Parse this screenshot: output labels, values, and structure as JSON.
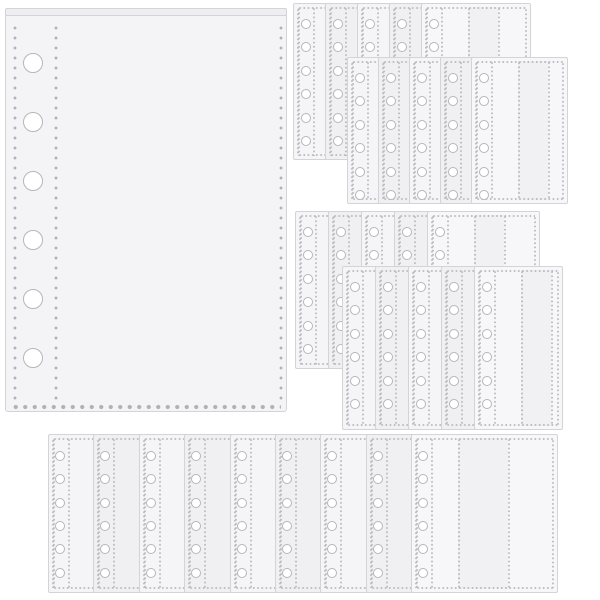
{
  "scene": {
    "width": 600,
    "height": 600,
    "background": "#ffffff",
    "subject": "transparent-6-ring-binder-sleeve-refill-pages",
    "colors": {
      "page_border": "#d4d4d8",
      "page_fill": "#f5f5f7",
      "page_fill_alt": "#f0f0f3",
      "top_page_fill": "#f7f7f9",
      "large_page_fill": "#f4f4f6",
      "flap_fill": "#eeeef1",
      "stitch_dot": "#bcbcc0",
      "stitch_dot_big": "#b2b2b6",
      "hole_ring": "#b6b6ba",
      "hole_fill": "#ffffff",
      "column_tint": "rgba(128,128,140,0.05)"
    },
    "large_page": {
      "x": 5,
      "y": 8,
      "width": 282,
      "height": 404,
      "flap_height": 8,
      "hole_count": 6,
      "hole_radius": 10,
      "hole_cx": 27,
      "hole_first_y": 54,
      "hole_spacing": 59,
      "dot_columns_x": [
        7,
        48,
        273
      ],
      "dots_top_y": 14,
      "bottom_dots_y": 395
    },
    "stack_page_spec": {
      "hole_count": 6,
      "hole_radius": 5,
      "hole_cx": 12,
      "hole_first_y": 20,
      "hole_spacing": 23.4,
      "strip_lines": [
        4,
        19
      ],
      "body_divider_start": 46,
      "body_divider_step": 30
    },
    "stacks": [
      {
        "name": "stack-top-left",
        "x": 293,
        "y": 3,
        "pages": 5,
        "offset_x": 32,
        "page_width": 110,
        "page_height": 157
      },
      {
        "name": "stack-top-right",
        "x": 347,
        "y": 57,
        "pages": 5,
        "offset_x": 31,
        "page_width": 97,
        "page_height": 147
      },
      {
        "name": "stack-middle-left",
        "x": 295,
        "y": 211,
        "pages": 5,
        "offset_x": 33,
        "page_width": 113,
        "page_height": 158
      },
      {
        "name": "stack-middle-right",
        "x": 342,
        "y": 266,
        "pages": 5,
        "offset_x": 33,
        "page_width": 89,
        "page_height": 164
      }
    ],
    "bottom_fan": {
      "name": "bottom-fan",
      "x": 48,
      "y": 434,
      "right_edge": 558,
      "page_height": 159,
      "pages": 9,
      "offset_x": 45.4,
      "page_width": 150,
      "spec": {
        "hole_count": 6,
        "hole_radius": 5,
        "hole_cx": 11,
        "hole_first_y": 21,
        "hole_spacing": 23.3,
        "strip_lines": [
          4,
          19
        ],
        "body_dividers": [
          46,
          96
        ]
      }
    }
  }
}
